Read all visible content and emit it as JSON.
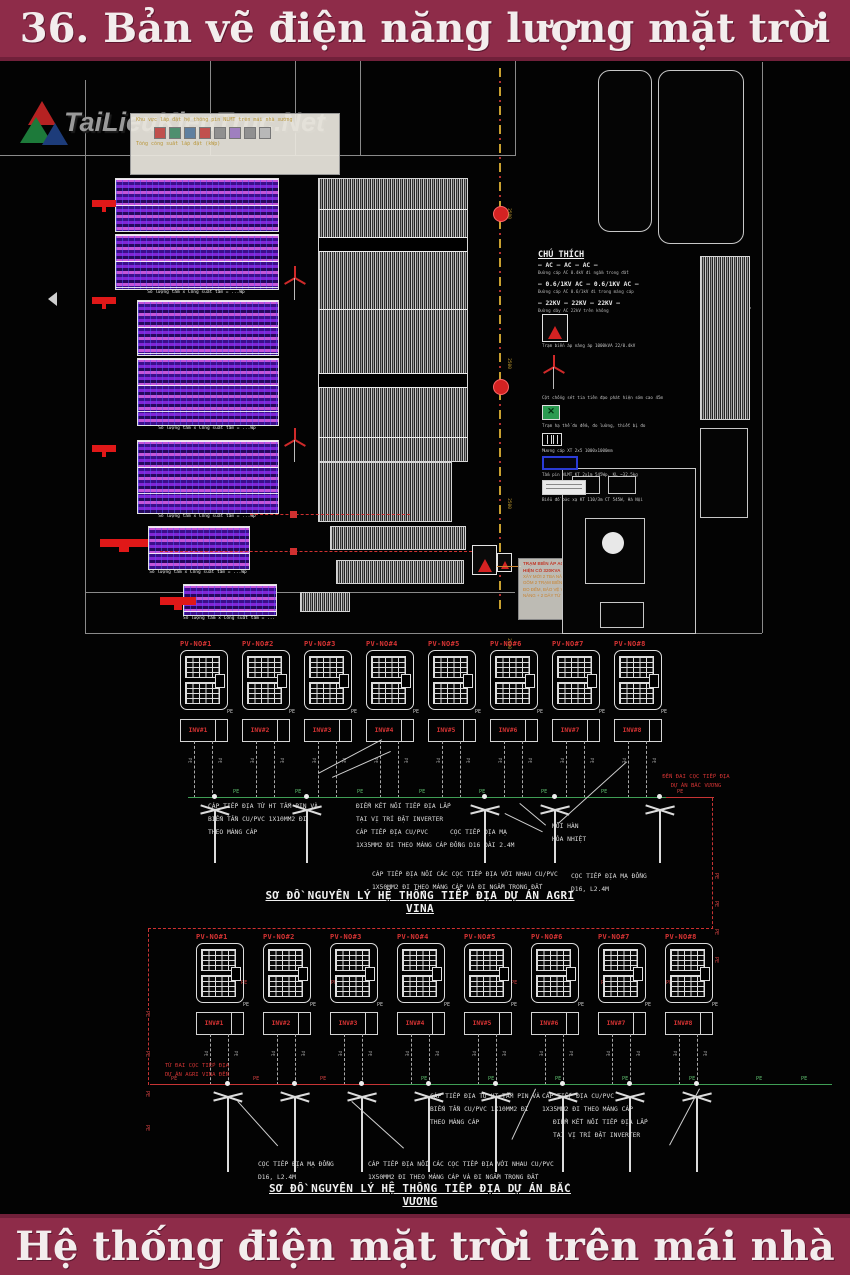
{
  "header": {
    "title": "36. Bản vẽ điện năng lượng mặt trời"
  },
  "footer": {
    "title": "Hệ thống điện mặt trời trên mái nhà"
  },
  "watermark": {
    "text": "TaiLieuKienTruc.Net"
  },
  "labels": {
    "pe": "PE"
  },
  "site_plan": {
    "block_caption": "Số lượng tấm x Công suất tấm = ...Wp",
    "info_box": {
      "lines": [
        "Khu vực lắp đặt hệ thống pin NLMT trên mái nhà xưởng",
        "Tổng công suất lắp đặt (kWp)"
      ],
      "swatches": [
        {
          "css": "background:#c0504d"
        },
        {
          "css": "background:#4f8f6f"
        },
        {
          "css": "background:#5f7f9f"
        },
        {
          "css": "background:#c0504d"
        },
        {
          "css": "background:#8f8f8f"
        },
        {
          "css": "background:#9f7fbf"
        },
        {
          "css": "background:#909090"
        },
        {
          "css": "background:#b8b8b8"
        }
      ]
    },
    "dims": [
      {
        "pos": "left:503px;top:150px",
        "val": "2500"
      },
      {
        "pos": "left:503px;top:300px",
        "val": "2500"
      },
      {
        "pos": "left:503px;top:440px",
        "val": "2500"
      },
      {
        "pos": "left:503px;top:580px",
        "val": "2190"
      }
    ],
    "note_box": [
      "TRẠM BIẾN ÁP AGRI VINA",
      "HIỆN CÓ 320KVA",
      "XÂY MỚI 2 TBA NÂNG ÁP CHO HỆ THỐNG NLMT",
      "GỒM 2 TRẠM BIẾN ÁP 22/0.4KV 1000KVA + HỆ THỐNG",
      "ĐO ĐẾM, BẢO VỆ VÀ TBA HỆ THỐNG ĐO ĐẾM ĐIỆN",
      "NĂNG + 2 DÂY TỪ HẠ THẾ 10M"
    ],
    "legend": {
      "title": "CHÚ THÍCH",
      "cables": [
        {
          "label": "— AC — AC — AC —",
          "caption": "Đường cáp AC 0.4kV đi ngầm trong đất"
        },
        {
          "label": "— 0.6/1KV AC — 0.6/1KV AC —",
          "caption": "Đường cáp AC 0.6/1kV đi trong máng cáp"
        },
        {
          "label": "— 22KV — 22KV — 22KV —",
          "caption": "Đường dây AC 22kV trên không"
        }
      ],
      "symbols": [
        {
          "caption": "Trạm biến áp nâng áp 1000kVA 22/0.4kV"
        },
        {
          "caption": "Cột chống sét tia tiên đạo phát hiện sớm cao 45m"
        },
        {
          "caption": "Trạm hạ thế đo đếm, đo lường, thiết bị đo"
        },
        {
          "caption": "Mương cáp XT 2x5 1000x1000mm"
        },
        {
          "caption": "Tấm pin NLMT KT 2x1m 545Wp, KL ~32.5kg"
        },
        {
          "caption": "Biểu đồ bức xạ KT 110/3m CT 545W, Hà Nội"
        }
      ]
    }
  },
  "schematics": [
    {
      "name": "agri-vina",
      "title": "SƠ ĐỒ NGUYÊN LÝ HỆ THỐNG TIẾP ĐỊA DỰ ÁN AGRI VINA",
      "units": [
        {
          "pv": "PV-NO#1",
          "inv": "INV#1",
          "pos": "left:180px"
        },
        {
          "pv": "PV-NO#2",
          "inv": "INV#2",
          "pos": "left:242px"
        },
        {
          "pv": "PV-NO#3",
          "inv": "INV#3",
          "pos": "left:304px"
        },
        {
          "pv": "PV-NO#4",
          "inv": "INV#4",
          "pos": "left:366px"
        },
        {
          "pv": "PV-NO#5",
          "inv": "INV#5",
          "pos": "left:428px"
        },
        {
          "pv": "PV-NO#6",
          "inv": "INV#6",
          "pos": "left:490px"
        },
        {
          "pv": "PV-NO#7",
          "inv": "INV#7",
          "pos": "left:552px"
        },
        {
          "pv": "PV-NO#8",
          "inv": "INV#8",
          "pos": "left:614px"
        }
      ],
      "electrodes": [
        {
          "pos": "left:197px"
        },
        {
          "pos": "left:289px"
        },
        {
          "pos": "left:467px"
        },
        {
          "pos": "left:537px"
        },
        {
          "pos": "left:642px"
        }
      ],
      "bus_pe_green": [
        {
          "pos": "left:232px"
        },
        {
          "pos": "left:294px"
        },
        {
          "pos": "left:356px"
        },
        {
          "pos": "left:418px"
        },
        {
          "pos": "left:478px"
        },
        {
          "pos": "left:540px"
        },
        {
          "pos": "left:600px"
        }
      ],
      "bus_pe_red": [
        {
          "pos": "left:676px"
        }
      ],
      "red_path_pe": [
        {
          "pos": "left:712px;top:812px;transform:rotate(90deg)"
        },
        {
          "pos": "left:712px;top:840px;transform:rotate(90deg)"
        },
        {
          "pos": "left:712px;top:868px;transform:rotate(90deg)"
        },
        {
          "pos": "left:712px;top:896px;transform:rotate(90deg)"
        },
        {
          "pos": "left:240px;top:919px"
        },
        {
          "pos": "left:330px;top:919px"
        },
        {
          "pos": "left:420px;top:919px"
        },
        {
          "pos": "left:510px;top:919px"
        },
        {
          "pos": "left:600px;top:919px"
        },
        {
          "pos": "left:665px;top:919px"
        },
        {
          "pos": "left:143px;top:950px;transform:rotate(90deg)"
        },
        {
          "pos": "left:143px;top:990px;transform:rotate(90deg)"
        },
        {
          "pos": "left:143px;top:1030px;transform:rotate(90deg)"
        },
        {
          "pos": "left:143px;top:1064px;transform:rotate(90deg)"
        }
      ],
      "annotations": {
        "a1": [
          "CÁP TIẾP ĐỊA TỪ HT TẤM PIN VÀ",
          "BIẾN TẦN  CU/PVC 1X10MM2 ĐI",
          "THEO MÁNG CÁP"
        ],
        "a2": [
          "ĐIỂM KẾT NỐI TIẾP ĐỊA LẮP",
          "TẠI VỊ TRÍ ĐẶT INVERTER",
          "CÁP TIẾP ĐỊA CU/PVC",
          "1X35MM2 ĐI THEO MÁNG CÁP"
        ],
        "a3": [
          "CỌC TIẾP ĐỊA MẠ",
          "ĐỒNG D16 DÀI 2.4M"
        ],
        "a4": [
          "MỐI HÀN",
          "HÓA NHIỆT"
        ],
        "a5": [
          "CỌC TIẾP ĐỊA MẠ ĐỒNG",
          "D16, L2.4M"
        ],
        "a6": [
          "ĐẾN ĐAI CỌC TIẾP ĐỊA",
          "DỰ ÁN BẮC VƯƠNG"
        ],
        "a7": [
          "CÁP TIẾP ĐỊA NỐI CÁC CỌC TIẾP ĐỊA VỚI NHAU CU/PVC",
          "1X50MM2 ĐI THEO MÁNG CÁP VÀ ĐI NGẦM TRONG ĐẤT"
        ]
      }
    },
    {
      "name": "bac-vuong",
      "title": "SƠ ĐỒ NGUYÊN LÝ HỆ THỐNG TIẾP ĐỊA DỰ ÁN BẮC VƯƠNG",
      "units": [
        {
          "pv": "PV-NO#1",
          "inv": "INV#1",
          "pos": "left:196px"
        },
        {
          "pv": "PV-NO#2",
          "inv": "INV#2",
          "pos": "left:263px"
        },
        {
          "pv": "PV-NO#3",
          "inv": "INV#3",
          "pos": "left:330px"
        },
        {
          "pv": "PV-NO#4",
          "inv": "INV#4",
          "pos": "left:397px"
        },
        {
          "pv": "PV-NO#5",
          "inv": "INV#5",
          "pos": "left:464px"
        },
        {
          "pv": "PV-NO#6",
          "inv": "INV#6",
          "pos": "left:531px"
        },
        {
          "pv": "PV-NO#7",
          "inv": "INV#7",
          "pos": "left:598px"
        },
        {
          "pv": "PV-NO#8",
          "inv": "INV#8",
          "pos": "left:665px"
        }
      ],
      "electrodes": [
        {
          "pos": "left:210px"
        },
        {
          "pos": "left:277px"
        },
        {
          "pos": "left:344px"
        },
        {
          "pos": "left:411px"
        },
        {
          "pos": "left:478px"
        },
        {
          "pos": "left:545px"
        },
        {
          "pos": "left:612px"
        },
        {
          "pos": "left:679px"
        }
      ],
      "bus_pe_red": [
        {
          "pos": "left:170px"
        },
        {
          "pos": "left:252px"
        },
        {
          "pos": "left:319px"
        }
      ],
      "bus_pe_green": [
        {
          "pos": "left:420px"
        },
        {
          "pos": "left:487px"
        },
        {
          "pos": "left:554px"
        },
        {
          "pos": "left:621px"
        },
        {
          "pos": "left:688px"
        },
        {
          "pos": "left:755px"
        },
        {
          "pos": "left:800px"
        }
      ],
      "annotations": {
        "b1": [
          "TỪ ĐAI CỌC TIẾP ĐỊA",
          "DỰ ÁN AGRI VINA ĐẾN"
        ],
        "b2": [
          "CÁP TIẾP ĐỊA TỪ HT TẤM PIN VÀ",
          "BIẾN TẦN  CU/PVC 1X10MM2 ĐI",
          "THEO MÁNG CÁP"
        ],
        "b3": [
          "CÁP TIẾP ĐỊA CU/PVC",
          "1X35MM2 ĐI THEO MÁNG CÁP"
        ],
        "b4": [
          "ĐIỂM KẾT NỐI TIẾP ĐỊA LẮP",
          "TẠI VỊ TRÍ ĐẶT INVERTER"
        ],
        "b5": [
          "CỌC TIẾP ĐỊA MẠ ĐỒNG",
          "D16, L2.4M"
        ],
        "b6": [
          "CÁP TIẾP ĐỊA NỐI CÁC CỌC TIẾP ĐỊA VỚI NHAU CU/PVC",
          "1X50MM2 ĐI THEO MÁNG CÁP VÀ ĐI NGẦM TRONG ĐẤT"
        ]
      }
    }
  ]
}
